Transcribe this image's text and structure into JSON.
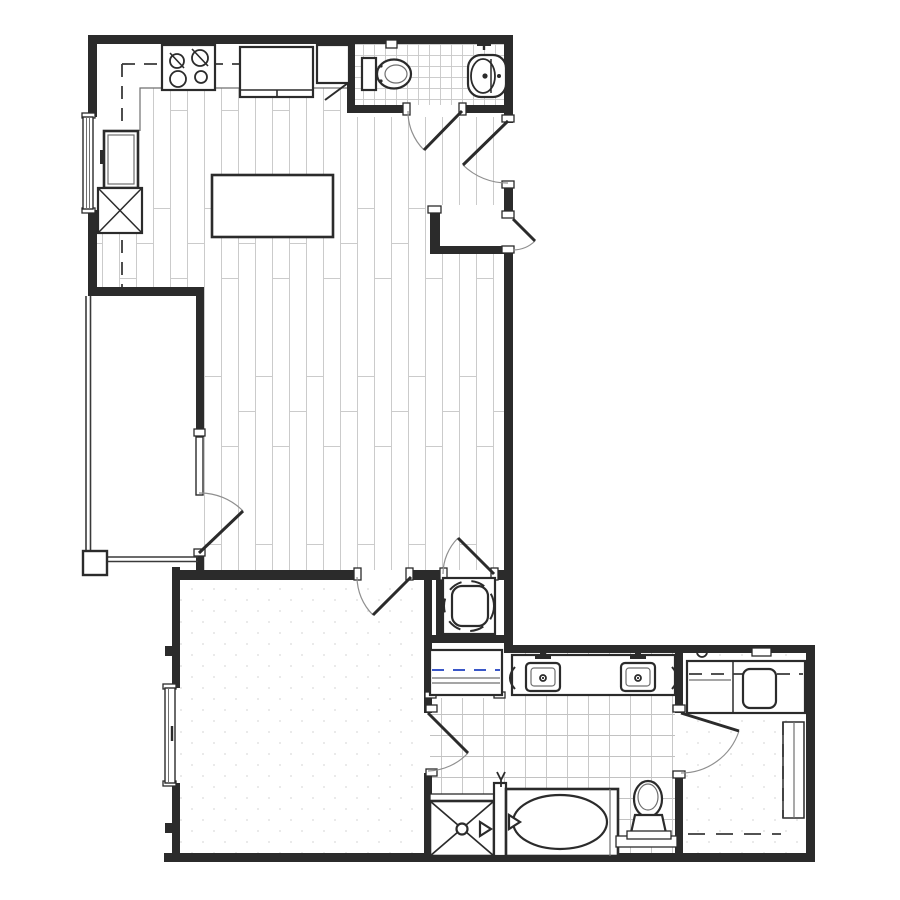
{
  "canvas": {
    "width": 900,
    "height": 900,
    "background": "#ffffff"
  },
  "palette": {
    "wall_fill": "#2b2b2b",
    "fixture_stroke": "#2b2b2b",
    "door_arc": "#8f8f8f",
    "thin_line": "#6f6f6f",
    "wood_plank_line": "#cbcbcb",
    "tile_line": "#c7c7c7",
    "carpet_dot": "#dadada",
    "closet_shelf_blue": "#3a57c8",
    "white": "#ffffff"
  },
  "plan": {
    "drawing_type": "residential one-bedroom apartment floor plan, black line architectural drawing, no text labels",
    "door_count": 8,
    "window_count": 2,
    "rooms": [
      {
        "id": "kitchen-living-dining",
        "floor_finish": "wood-plank"
      },
      {
        "id": "powder-room",
        "floor_finish": "small-tile",
        "fixtures": [
          "toilet",
          "pedestal-sink",
          "paper-holder"
        ]
      },
      {
        "id": "entry",
        "fixtures": [
          "entry-door-inswing",
          "service-door-outswing",
          "storage-niche"
        ]
      },
      {
        "id": "balcony",
        "floor_finish": "plain",
        "fixtures": [
          "railing",
          "corner-post",
          "glazed-door-with-sidelite"
        ]
      },
      {
        "id": "bedroom",
        "floor_finish": "carpet",
        "fixtures": [
          "window"
        ]
      },
      {
        "id": "laundry-closet",
        "fixtures": [
          "stacked-washer-dryer"
        ]
      },
      {
        "id": "linen-closet",
        "fixtures": [
          "shelf-cabinet-with-blue-dashed-rod"
        ]
      },
      {
        "id": "bathroom",
        "floor_finish": "large-tile",
        "fixtures": [
          "double-vanity",
          "sink-left",
          "sink-right",
          "faucets",
          "towel-bars",
          "bathtub",
          "tub-spout",
          "shower-with-x",
          "shower-head",
          "toilet",
          "back-ledge"
        ]
      },
      {
        "id": "walk-in-closet",
        "floor_finish": "carpet",
        "fixtures": [
          "built-in-counter",
          "seat",
          "shelf-tower",
          "hanging-rod-dashed",
          "knob-circle",
          "wall-switch-plate"
        ]
      }
    ],
    "kitchen_fixtures": [
      "range-four-burner",
      "refrigerator",
      "corner-cabinet",
      "tall-cabinet",
      "mechanical-chase-x",
      "kitchen-island",
      "upper-cabinet-dashed-line",
      "counter-edge",
      "window"
    ]
  }
}
